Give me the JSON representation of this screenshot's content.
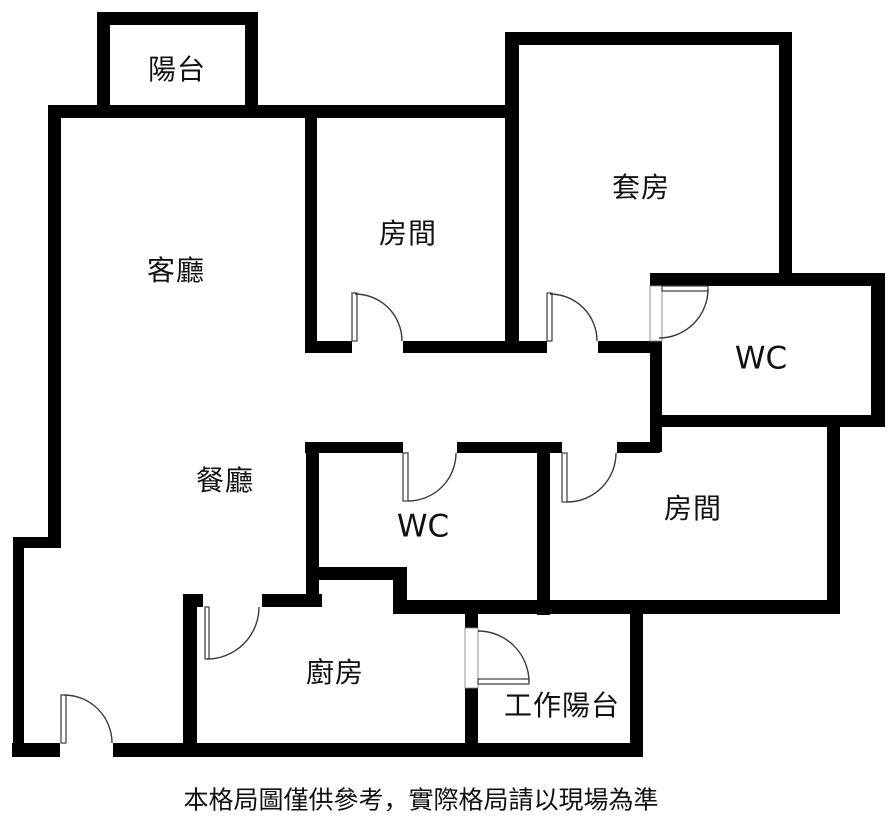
{
  "colors": {
    "wall": "#000000",
    "door_line": "#3a3a3a",
    "text": "#111111",
    "background": "#ffffff"
  },
  "rooms": [
    {
      "id": "balcony",
      "label": "陽台"
    },
    {
      "id": "living-room",
      "label": "客廳"
    },
    {
      "id": "bedroom-top",
      "label": "房間"
    },
    {
      "id": "suite",
      "label": "套房"
    },
    {
      "id": "suite-bathroom",
      "label": "WC"
    },
    {
      "id": "dining-room",
      "label": "餐廳"
    },
    {
      "id": "bathroom",
      "label": "WC"
    },
    {
      "id": "bedroom-right",
      "label": "房間"
    },
    {
      "id": "kitchen",
      "label": "廚房"
    },
    {
      "id": "utility-balcony",
      "label": "工作陽台"
    }
  ],
  "disclaimer": "本格局圖僅供參考，實際格局請以現場為準"
}
